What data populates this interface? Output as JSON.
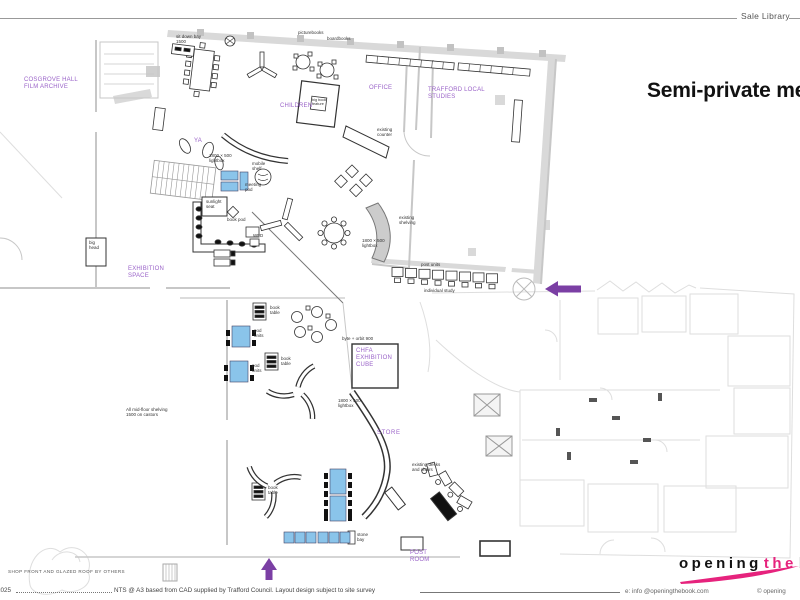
{
  "header": {
    "doc_label": "Sale Library",
    "title": "Semi-private meetings"
  },
  "rooms": [
    {
      "id": "cosgrove",
      "label": "COSGROVE HALL\nFILM ARCHIVE"
    },
    {
      "id": "children",
      "label": "CHILDREN"
    },
    {
      "id": "office",
      "label": "OFFICE"
    },
    {
      "id": "trafford",
      "label": "TRAFFORD LOCAL\nSTUDIES"
    },
    {
      "id": "exhibition",
      "label": "EXHIBITION\nSPACE"
    },
    {
      "id": "ya",
      "label": "YA"
    },
    {
      "id": "chfa-cube",
      "label": "CHFA\nEXHIBITION\nCUBE"
    },
    {
      "id": "store",
      "label": "STORE"
    },
    {
      "id": "post-room",
      "label": "POST\nROOM"
    }
  ],
  "annotations": [
    "sit down bay\n1500",
    "picturebooks",
    "boardbooks",
    "big book\nfeature",
    "existing\ncounter",
    "1800 × 500\nlightbox",
    "existing\nshelving",
    "1800 × 500\nlightbox",
    "mobile\nshelf",
    "meeting\npod",
    "sunlight\nseat",
    "book pod",
    "WFD",
    "post units",
    "individual study",
    "book\ntable",
    "pod\nunits",
    "book\ntable",
    "pod\nunits",
    "byte + orbit 900",
    "1800 × 500\nlightbox",
    "book\ntable",
    "existing desks\nand chairs",
    "All mid-floor shelving\n1500 on castors",
    "big\nhead",
    "stone\nbay"
  ],
  "footer": {
    "year": "2025",
    "note": "NTS @ A3 based from CAD supplied by Trafford Council. Layout design subject to site survey",
    "email": "e: info @openingthebook.com",
    "copyright": "© opening",
    "shop_note": "SHOP FRONT AND GLAZED ROOF BY OTHERS"
  },
  "logo": {
    "word1": "opening",
    "word2": "the",
    "word3": "b"
  },
  "colors": {
    "room_label_purple": "#9a63c8",
    "arrow_purple": "#7b3fa4",
    "furniture_blue": "#8ac4ea",
    "logo_pink": "#e6237d",
    "wall_gray": "#d9d9d9"
  }
}
